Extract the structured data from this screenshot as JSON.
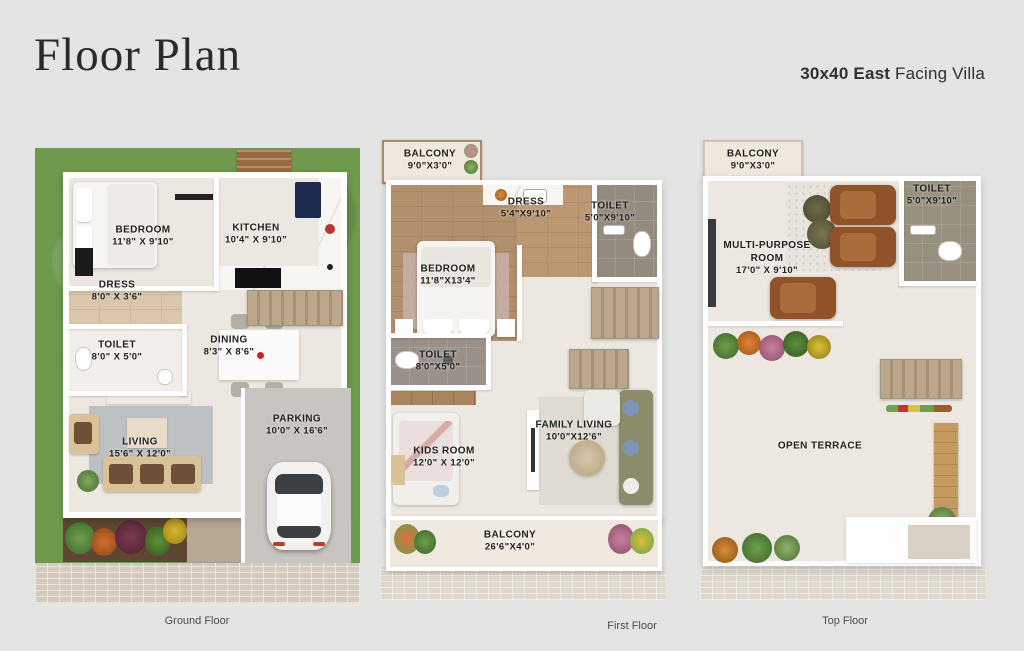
{
  "header": {
    "title": "Floor Plan",
    "subtitle_bold": "30x40 East",
    "subtitle_rest": " Facing Villa"
  },
  "floors": {
    "ground": {
      "caption": "Ground Floor",
      "rooms": {
        "bedroom": {
          "name": "BEDROOM",
          "dims": "11'8\" X 9'10\""
        },
        "kitchen": {
          "name": "KITCHEN",
          "dims": "10'4\" X 9'10\""
        },
        "dress": {
          "name": "DRESS",
          "dims": "8'0\" X 3'6\""
        },
        "toilet": {
          "name": "TOILET",
          "dims": "8'0\" X 5'0\""
        },
        "dining": {
          "name": "DINING",
          "dims": "8'3\" X 8'6\""
        },
        "living": {
          "name": "LIVING",
          "dims": "15'6\" X 12'0\""
        },
        "parking": {
          "name": "PARKING",
          "dims": "10'0\" X 16'6\""
        }
      }
    },
    "first": {
      "caption": "First Floor",
      "rooms": {
        "balcony_top": {
          "name": "BALCONY",
          "dims": "9'0\"X3'0\""
        },
        "dress": {
          "name": "DRESS",
          "dims": "5'4\"X9'10\""
        },
        "toilet_top": {
          "name": "TOILET",
          "dims": "5'0\"X9'10\""
        },
        "bedroom": {
          "name": "BEDROOM",
          "dims": "11'8\"X13'4\""
        },
        "toilet_mid": {
          "name": "TOILET",
          "dims": "8'0\"X5'0\""
        },
        "kids_room": {
          "name": "KIDS ROOM",
          "dims": "12'0\" X 12'0\""
        },
        "family_living": {
          "name": "FAMILY LIVING",
          "dims": "10'0\"X12'6\""
        },
        "balcony_bottom": {
          "name": "BALCONY",
          "dims": "26'6\"X4'0\""
        }
      }
    },
    "top": {
      "caption": "Top Floor",
      "rooms": {
        "balcony": {
          "name": "BALCONY",
          "dims": "9'0\"X3'0\""
        },
        "toilet": {
          "name": "TOILET",
          "dims": "5'0\"X9'10\""
        },
        "multi_purpose": {
          "name": "MULTI-PURPOSE ROOM",
          "dims": "17'0\" X 9'10\""
        },
        "open_terrace": {
          "name": "OPEN TERRACE"
        }
      }
    }
  },
  "palette": {
    "page_bg": "#e4e5e2",
    "grass_green": "#6f9a4d",
    "floor_cream": "#ece7e0",
    "wood_floor": "#b3906c",
    "toilet_gray": "#948b7f",
    "wall_white": "#ffffff",
    "stairs_tan": "#b7a189",
    "label_text": "#22211f"
  }
}
